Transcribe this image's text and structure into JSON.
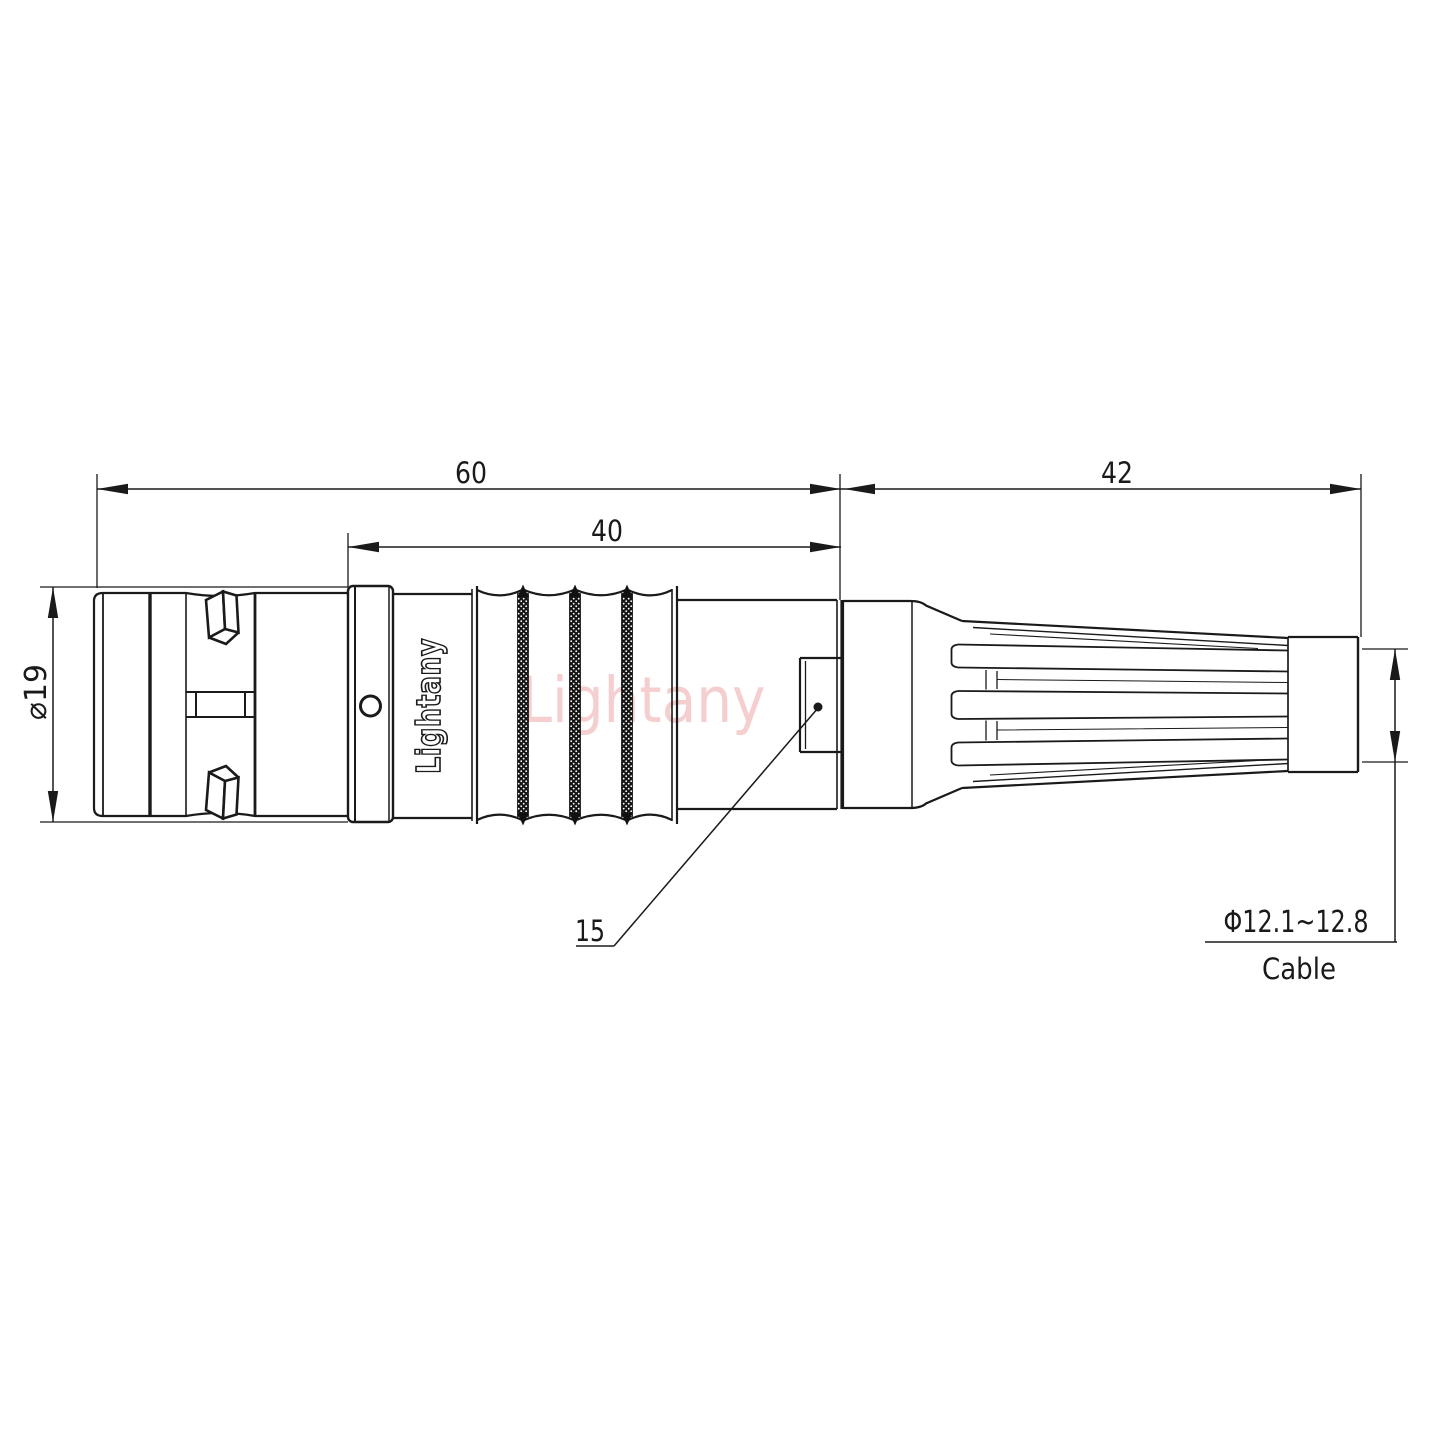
{
  "drawing": {
    "kind": "connector outline technical drawing",
    "watermark": "Lightany",
    "engraving": "Lightany",
    "labels": {
      "total_length": "60",
      "rear_section_length": "40",
      "boot_length": "42",
      "shell_diameter": "⌀19",
      "key_feature": "15",
      "cable_diameter": "Φ12.1~12.8",
      "cable": "Cable"
    },
    "colors": {
      "line": "#1a1a1a",
      "watermark_pink": "#f5cfcf",
      "background": "#ffffff",
      "knurl_dark": "#141414"
    }
  }
}
